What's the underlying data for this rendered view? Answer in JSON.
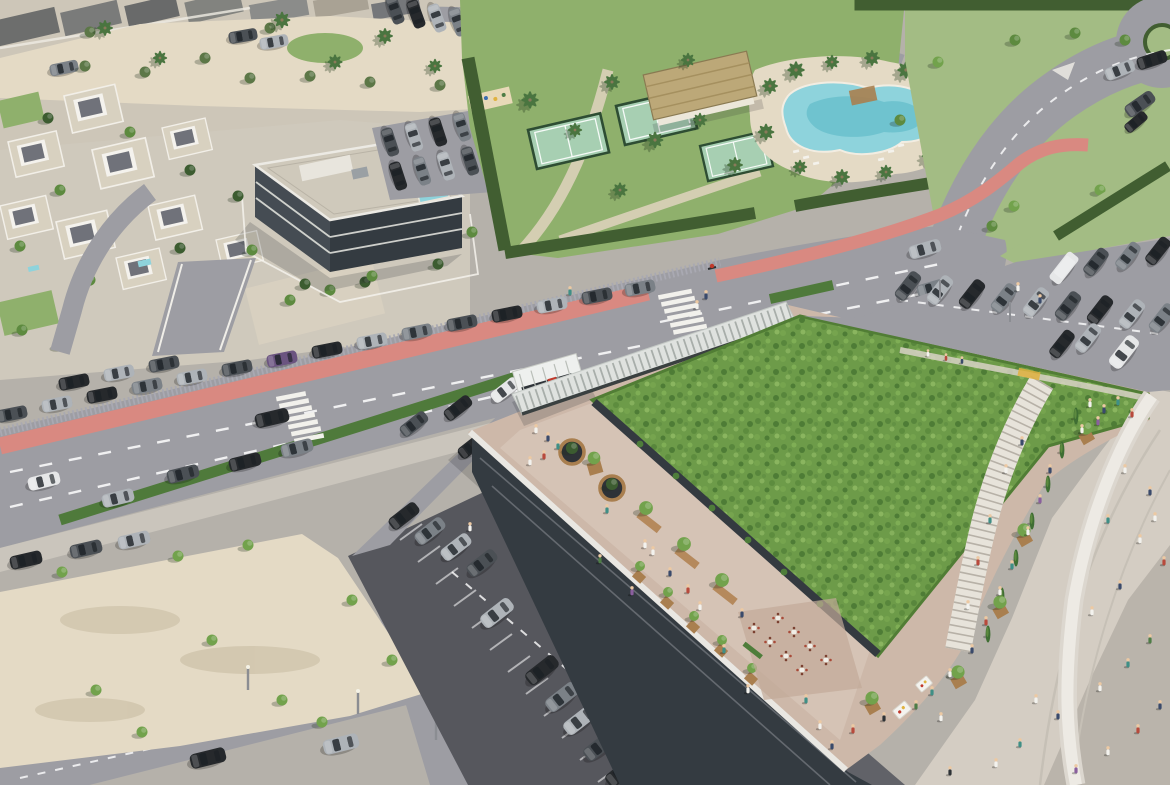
{
  "meta": {
    "type": "aerial-architectural-rendering",
    "description": "Aerial CGI rendering of a coastal mixed-use development: a commercial building with a large planted green roof and rooftop promenade with cafe terraces and market stalls, surface parking lots with cars, a landscaped sports club with lagoon pool, clubhouse and padel courts, white villas, a dark apartment block, palm trees, and a wide avenue with a red bike lane, hedges, crosswalks and a roundabout.",
    "width": 1170,
    "height": 785
  },
  "palette": {
    "sand": "#e4dac5",
    "sand_dark": "#d2c7ad",
    "road": "#9d9da3",
    "road_dark": "#8e8e95",
    "lot": "#56575d",
    "apron": "#616268",
    "sidewalk": "#cac5bc",
    "promenade": "#d4cdc3",
    "promenade_dark": "#bab4ab",
    "ramp": "#e9e6e0",
    "steps": "#e7e3da",
    "bike": "#d98981",
    "hedge": "#415e31",
    "hedge_light": "#4f7a3b",
    "lawn": "#8fb06c",
    "field": "#a3bc84",
    "meadow": "#6d9b49",
    "meadow_dark": "#4e7c36",
    "meadow_light": "#85b05c",
    "court": "#a7cfb2",
    "pool": "#8ed3dc",
    "pool_deep": "#62bcc9",
    "bldg": "#343b41",
    "bldg_mid": "#454c53",
    "roof_light": "#cfc9bb",
    "parapet": "#e9e7e2",
    "terrace": "#cdb8a9",
    "terrace_light": "#d9c8bb",
    "wood": "#a97f4f",
    "thatch": "#bca878",
    "white": "#f2f1ec",
    "car_black": "#26292c",
    "car_dark": "#4b5055",
    "car_grey": "#7b8187",
    "car_silver": "#aeb3b8",
    "car_white": "#e6e7e8",
    "car_purple": "#6b5480",
    "tree_dark": "#3c5c30",
    "tree_mid": "#5d8a3f",
    "tree_light": "#72a24c",
    "olive": "#5c7747",
    "palm": "#4a7540",
    "accent_red": "#c0392b",
    "accent_yellow": "#e0b23f"
  },
  "scene": {
    "landmarks": [
      {
        "name": "green-roof-building"
      },
      {
        "name": "rooftop-terrace"
      },
      {
        "name": "sports-club"
      },
      {
        "name": "lagoon-pool"
      },
      {
        "name": "padel-courts"
      },
      {
        "name": "clubhouse"
      },
      {
        "name": "apartment-building"
      },
      {
        "name": "villa-district"
      },
      {
        "name": "main-avenue"
      },
      {
        "name": "bike-lane"
      },
      {
        "name": "roundabout"
      },
      {
        "name": "center-parking-lot"
      },
      {
        "name": "right-parking-lot"
      },
      {
        "name": "sand-plaza"
      },
      {
        "name": "promenade"
      }
    ]
  }
}
